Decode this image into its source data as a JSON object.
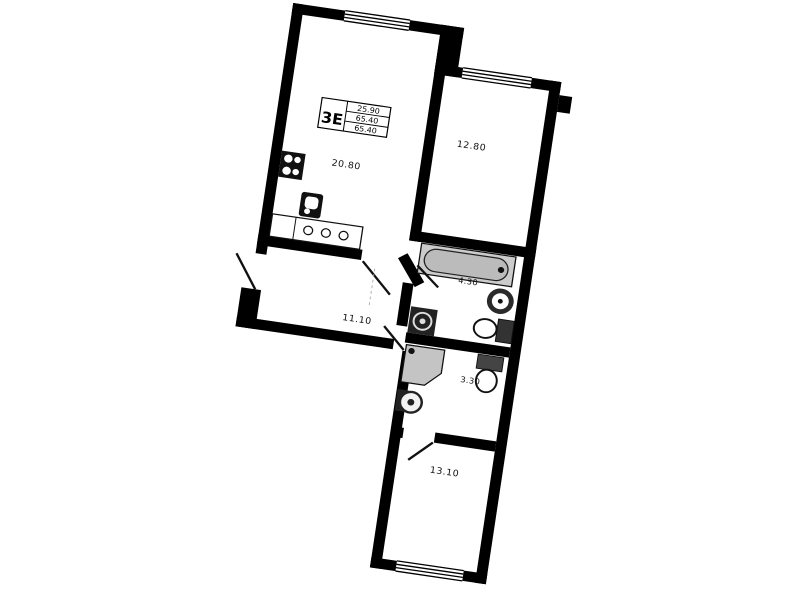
{
  "page": {
    "kind": "apartment floor plan drawing",
    "background_color": "#ffffff",
    "wall_color": "#000000",
    "fixture_gray": "#c6c6c6"
  },
  "title_block": {
    "type_label": "3Е",
    "living_area": "25.90",
    "total_area": "65.40",
    "total_area_with_balcony": "65.40"
  },
  "rooms": [
    {
      "id": "living-kitchen",
      "area_label": "20.80"
    },
    {
      "id": "bedroom-1",
      "area_label": "12.80"
    },
    {
      "id": "bathroom",
      "area_label": "4.30"
    },
    {
      "id": "hallway",
      "area_label": "11.10"
    },
    {
      "id": "wc",
      "area_label": "3.30"
    },
    {
      "id": "bedroom-2",
      "area_label": "13.10"
    }
  ],
  "fixtures": [
    "stove",
    "kitchen-sink",
    "kitchen-counter",
    "bathtub",
    "round-sink",
    "toilet",
    "washing-machine",
    "shower",
    "toilet-2",
    "washing-machine-2"
  ],
  "windows": [
    "living-kitchen-window",
    "bedroom-1-window",
    "bedroom-2-window"
  ],
  "doors": [
    "entrance-door",
    "living-room-door",
    "bathroom-door",
    "wc-door",
    "bedroom-2-door"
  ]
}
